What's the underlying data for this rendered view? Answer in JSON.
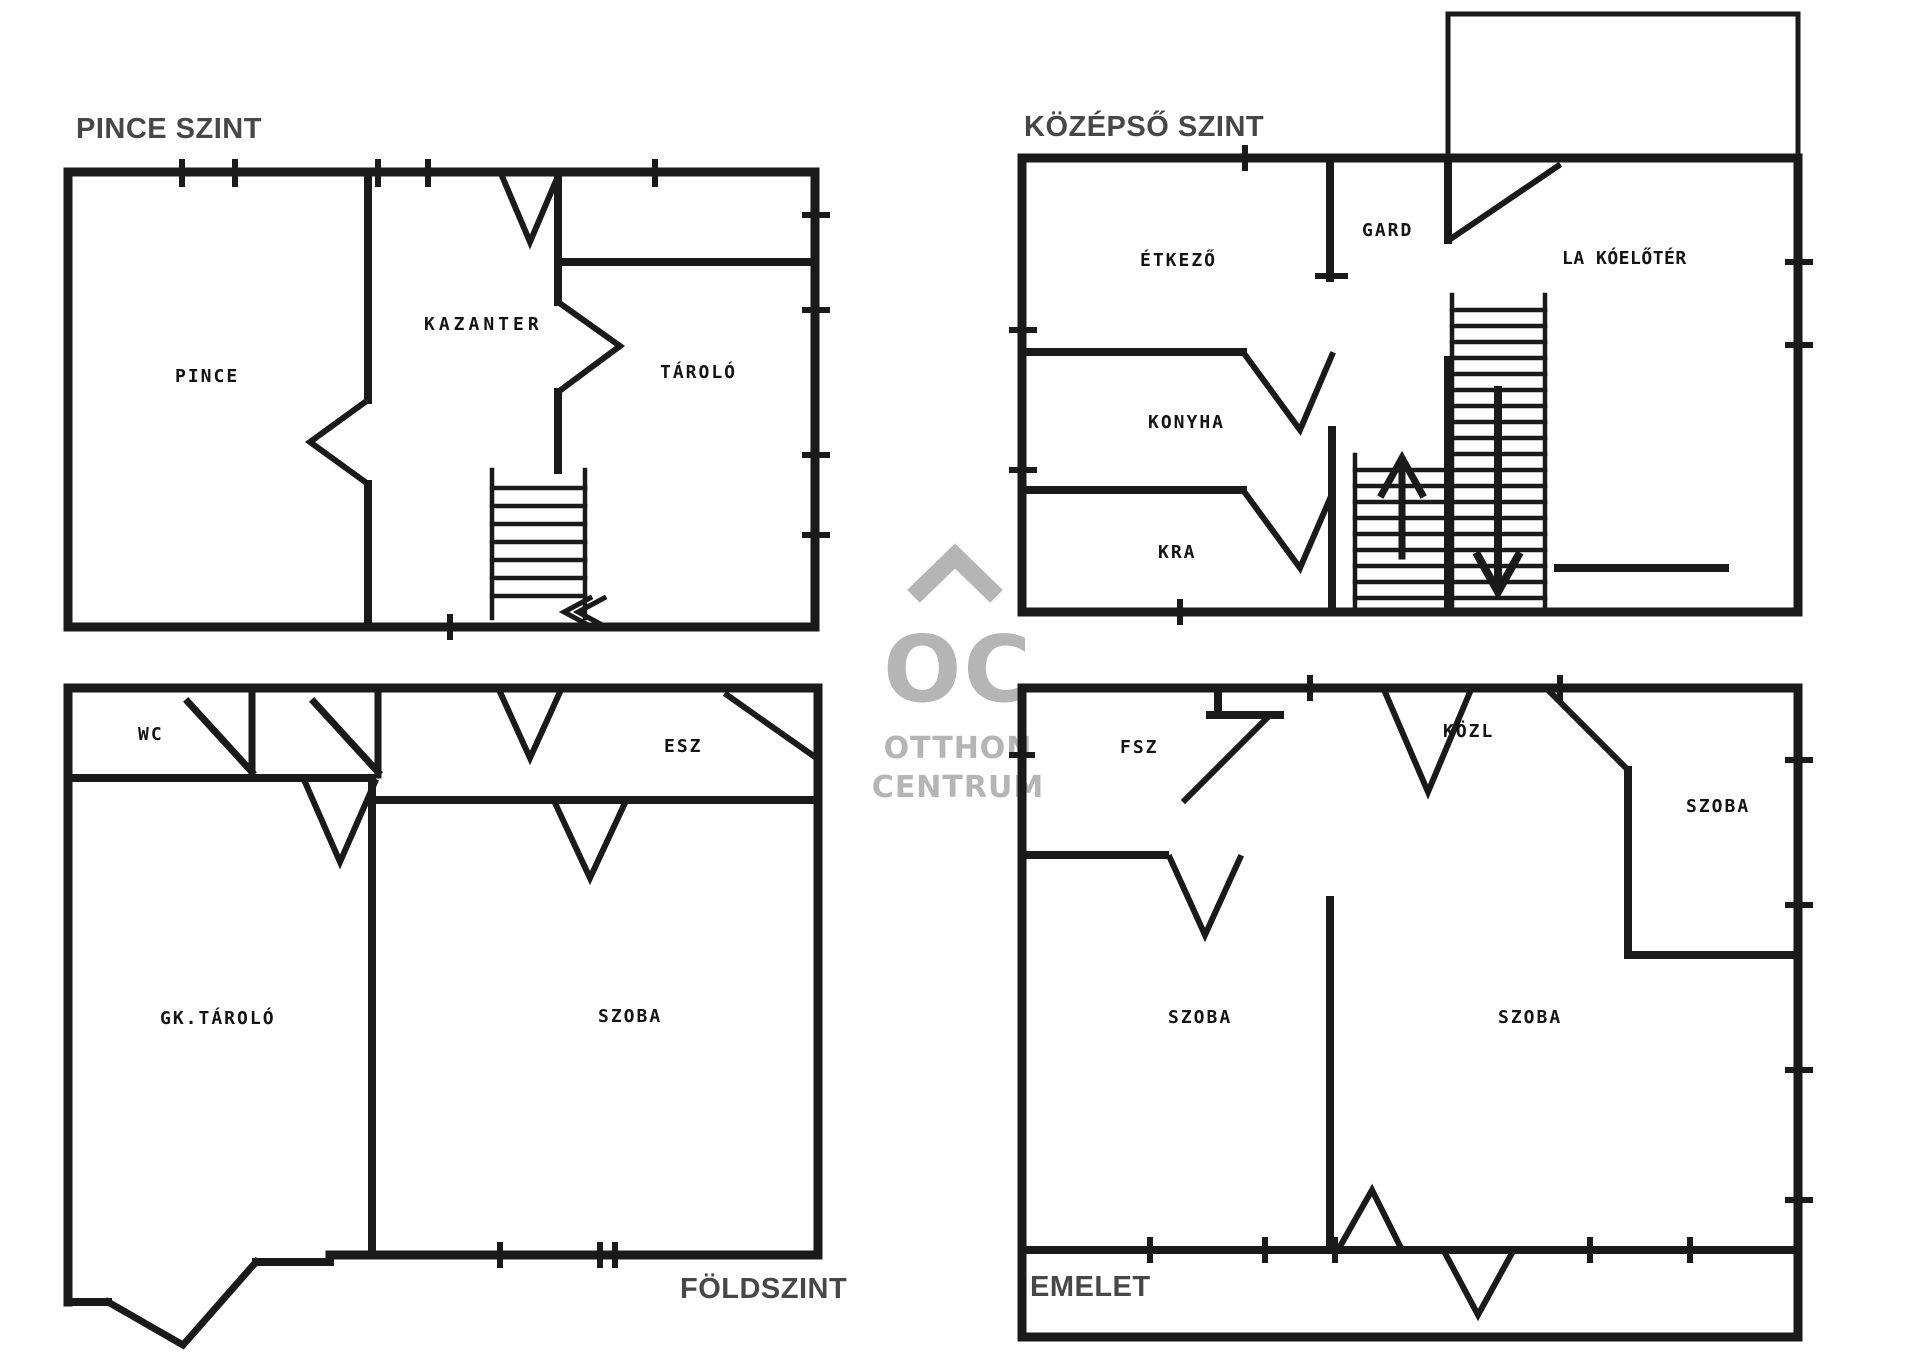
{
  "sheet": {
    "background": "#ffffff",
    "type": "floor-plan-sheet"
  },
  "colors": {
    "wall": "#1a1a1a",
    "title_text": "#474747",
    "room_label_text": "#141414",
    "watermark": "#b5b5b5"
  },
  "plans": {
    "basement": {
      "title": "PINCE SZINT",
      "rooms": {
        "pince": "PINCE",
        "kazanter": "KAZANTER",
        "tarolo": "TÁROLÓ"
      }
    },
    "middle": {
      "title": "KÖZÉPSŐ SZINT",
      "rooms": {
        "etkezo": "ÉTKEZŐ",
        "gard": "GARD",
        "lakoeloter": "LA KÓELŐTÉR",
        "konyha": "KONYHA",
        "kra": "KRA"
      }
    },
    "ground": {
      "title": "FÖLDSZINT",
      "rooms": {
        "wc": "WC",
        "esz": "ESZ",
        "gk_tarolo": "GK.TÁROLÓ",
        "szoba": "SZOBA"
      }
    },
    "upper": {
      "title": "EMELET",
      "rooms": {
        "fsz": "FSZ",
        "kozl": "KÖZL",
        "szoba_top_right": "SZOBA",
        "szoba_bottom_left": "SZOBA",
        "szoba_bottom_right": "SZOBA"
      }
    }
  },
  "watermark": {
    "monogram": "OC",
    "line1": "OTTHON",
    "line2": "CENTRUM",
    "icon": "roof-chevron-icon"
  }
}
